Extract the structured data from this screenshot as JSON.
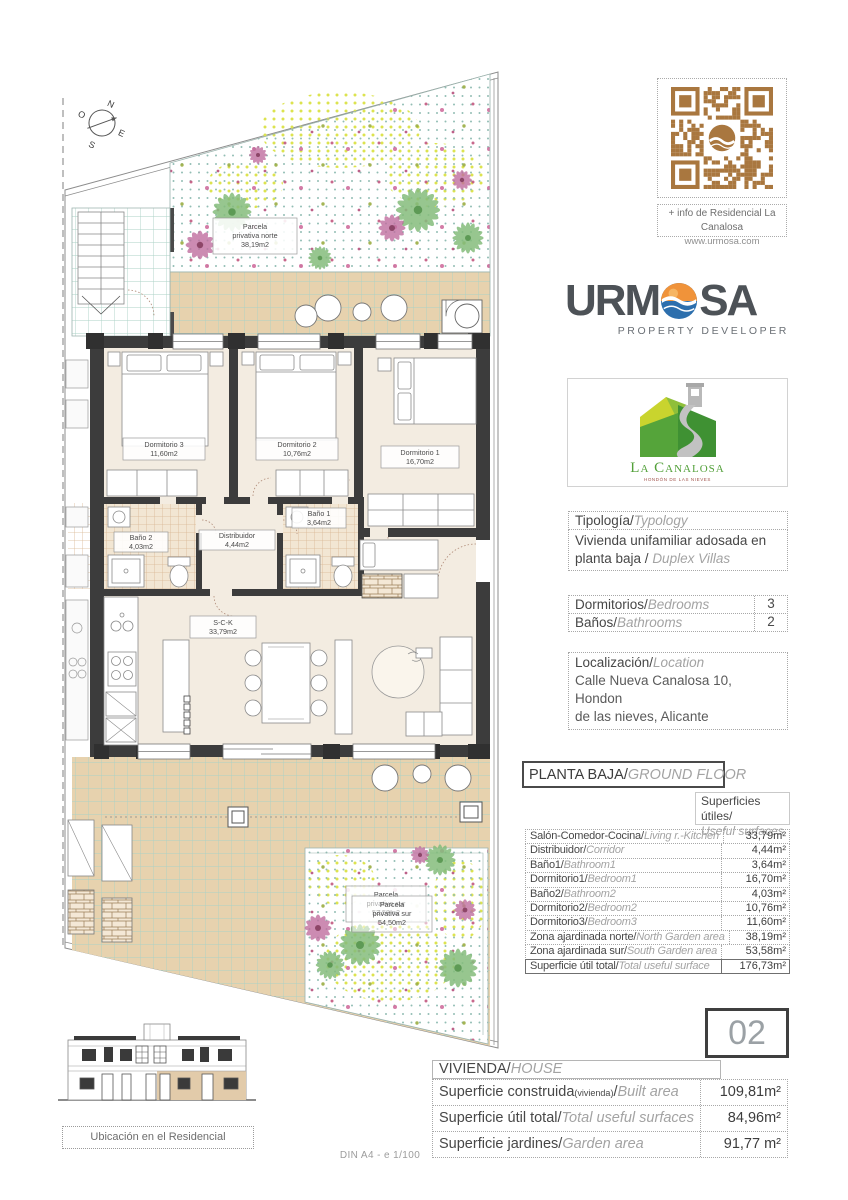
{
  "sheet": {
    "scale_note": "DIN A4 - e 1/100"
  },
  "qr": {
    "caption": "+ info de Residencial La Canalosa",
    "url": "www.urmosa.com"
  },
  "brand": {
    "left": "URM",
    "right": "SA",
    "tagline": "PROPERTY DEVELOPER"
  },
  "resort": {
    "name": "La Canalosa",
    "town": "HONDÓN DE LAS NIEVES"
  },
  "typology": {
    "label_es": "Tipología/",
    "label_en": "Typology",
    "line1": "Vivienda unifamiliar adosada en",
    "line2_es": "planta baja / ",
    "line2_en": "Duplex Villas"
  },
  "counts": {
    "bedrooms": {
      "es": "Dormitorios/",
      "en": "Bedrooms",
      "value": "3"
    },
    "bathrooms": {
      "es": "Baños/",
      "en": "Bathrooms",
      "value": "2"
    }
  },
  "location": {
    "label_es": "Localización/",
    "label_en": "Location",
    "line1": "Calle Nueva Canalosa 10, Hondon",
    "line2": "de las nieves, Alicante"
  },
  "floor": {
    "title_es": "PLANTA BAJA/",
    "title_en": "GROUND FLOOR",
    "col_es": "Superficies útiles/",
    "col_en": "Useful surfaces",
    "rows": [
      {
        "es": "Salón-Comedor-Cocina/",
        "en": "Living r.-Kitchen",
        "value": "33,79m²"
      },
      {
        "es": "Distribuidor/",
        "en": "Corridor",
        "value": "4,44m²"
      },
      {
        "es": "Baño1/",
        "en": "Bathroom1",
        "value": "3,64m²"
      },
      {
        "es": "Dormitorio1/",
        "en": "Bedroom1",
        "value": "16,70m²"
      },
      {
        "es": "Baño2/",
        "en": "Bathroom2",
        "value": "4,03m²"
      },
      {
        "es": "Dormitorio2/",
        "en": "Bedroom2",
        "value": "10,76m²"
      },
      {
        "es": "Dormitorio3/",
        "en": "Bedroom3",
        "value": "11,60m²"
      },
      {
        "es": "Zona ajardinada norte/",
        "en": "North Garden area",
        "value": "38,19m²"
      },
      {
        "es": "Zona ajardinada sur/",
        "en": "South Garden area",
        "value": "53,58m²"
      }
    ],
    "total": {
      "es": "Superficie útil total/",
      "en": "Total useful surface",
      "value": "176,73m²"
    }
  },
  "unit": {
    "number": "02",
    "header_es": "VIVIENDA/",
    "header_en": "HOUSE",
    "rows": [
      {
        "es": "Superficie construida",
        "es_note": "(vivienda)",
        "sep": "/",
        "en": "Built area",
        "value": "109,81m²"
      },
      {
        "es": "Superficie útil total/",
        "en": "Total useful surfaces",
        "value": "84,96m²"
      },
      {
        "es": "Superficie jardines/",
        "en": "Garden area",
        "value": "91,77 m²"
      }
    ]
  },
  "plan": {
    "compass": {
      "n": "N",
      "e": "E",
      "s": "S",
      "o": "O"
    },
    "labels": {
      "garden_north": [
        "Parcela",
        "privativa norte",
        "38,19m2"
      ],
      "garden_south_a": [
        "Parcela",
        "privativa sur",
        "53,58m2"
      ],
      "garden_south_b": [
        "Parcela",
        "privativa sur",
        "54,50m2"
      ],
      "dorm3": [
        "Dormitorio 3",
        "11,60m2"
      ],
      "dorm2": [
        "Dormitorio 2",
        "10,76m2"
      ],
      "dorm1": [
        "Dormitorio 1",
        "16,70m2"
      ],
      "bano2": [
        "Baño 2",
        "4,03m2"
      ],
      "bano1": [
        "Baño 1",
        "3,64m2"
      ],
      "distribuidor": [
        "Distribuidor",
        "4,44m2"
      ],
      "sck": [
        "S-C-K",
        "33,79m2"
      ]
    },
    "caption": "Ubicación en el Residencial"
  },
  "colors": {
    "qr_brown": "#A9773F",
    "sun_orange": "#F0933A",
    "sea_blue": "#2D6FAD",
    "logo_green": "#53A03A",
    "terrace_tan": "#E7D2AE",
    "room_beige": "#F3ECE1"
  }
}
